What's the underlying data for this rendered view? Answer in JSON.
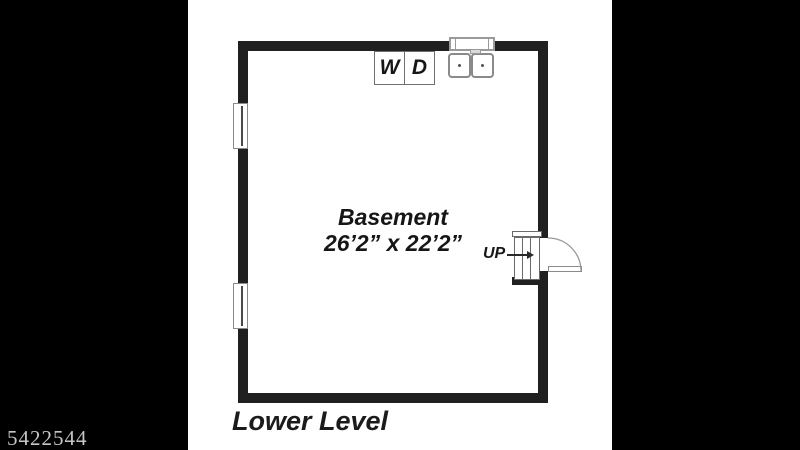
{
  "watermark": {
    "id": "5422544"
  },
  "plan": {
    "room": {
      "name": "Basement",
      "dimensions": "26’2” x 22’2”"
    },
    "floor_label": "Lower Level",
    "fixtures": {
      "washer_label": "W",
      "dryer_label": "D",
      "stairs_direction_label": "UP"
    },
    "colors": {
      "letterbox": "#000000",
      "wall": "#202020",
      "fixture_outline": "#8a8a8a",
      "label_text": "#161616",
      "watermark_text": "#c6c6c6"
    }
  }
}
